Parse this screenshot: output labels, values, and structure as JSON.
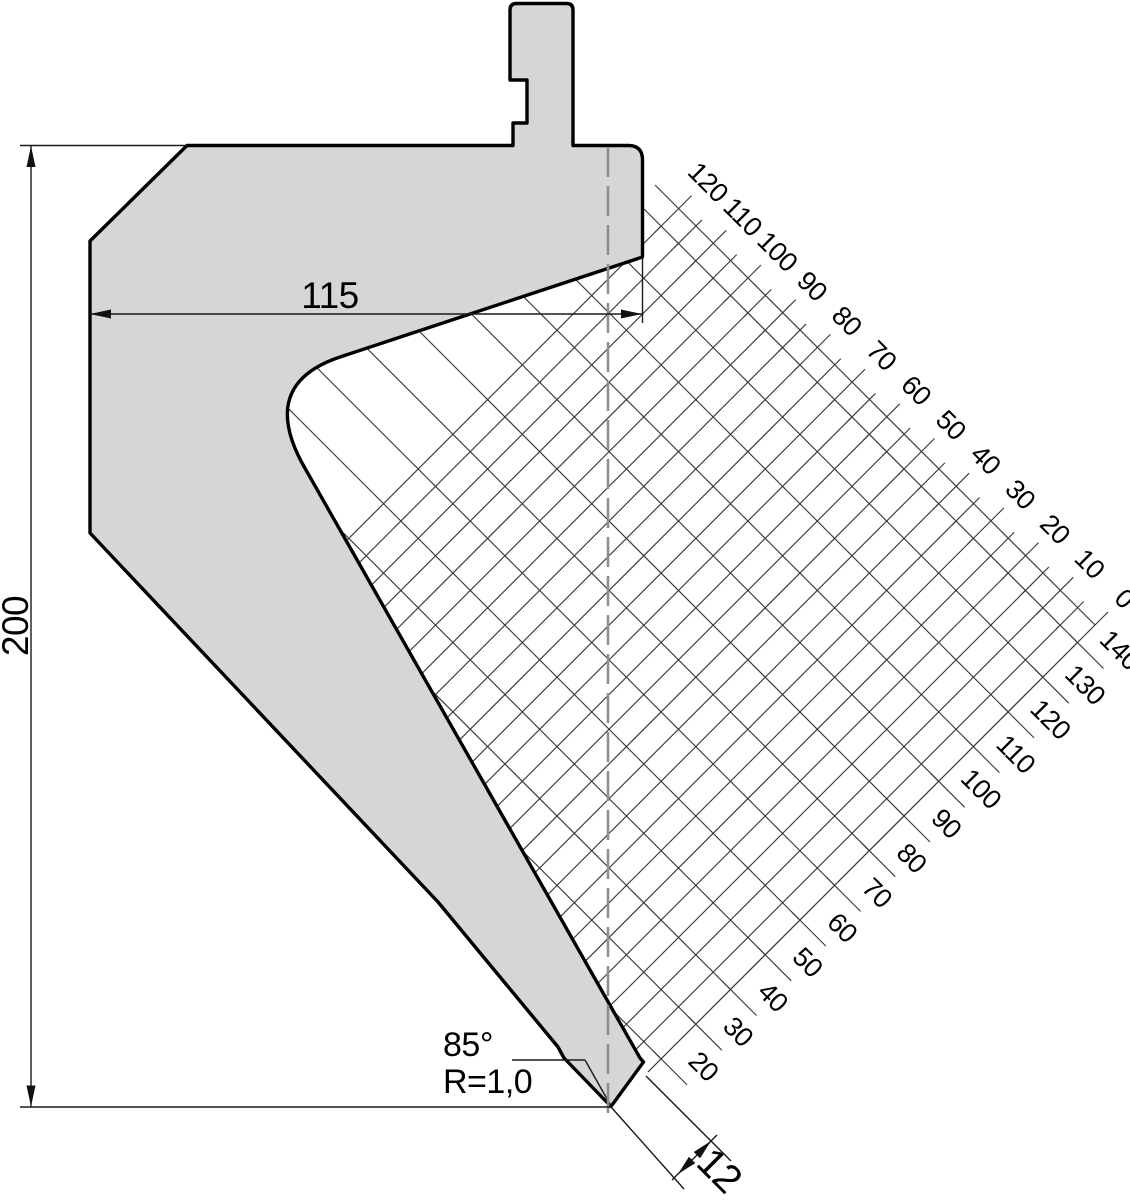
{
  "drawing": {
    "type": "press-brake-punch-technical-drawing",
    "dimensions": {
      "height": "200",
      "width": "115",
      "tip_angle": "85°",
      "tip_radius": "R=1,0",
      "offset": "12"
    },
    "scales": {
      "ne": [
        "120",
        "110",
        "100",
        "90",
        "80",
        "70",
        "60",
        "50",
        "40",
        "30",
        "20",
        "10",
        "0"
      ],
      "se": [
        "140",
        "130",
        "120",
        "110",
        "100",
        "90",
        "80",
        "70",
        "60",
        "50",
        "40",
        "30",
        "20"
      ]
    },
    "colors": {
      "body_fill": "#d6d6d6",
      "outline": "#000000",
      "hatch_line": "#3a3a3a",
      "centerline": "#8f8f8f"
    }
  }
}
